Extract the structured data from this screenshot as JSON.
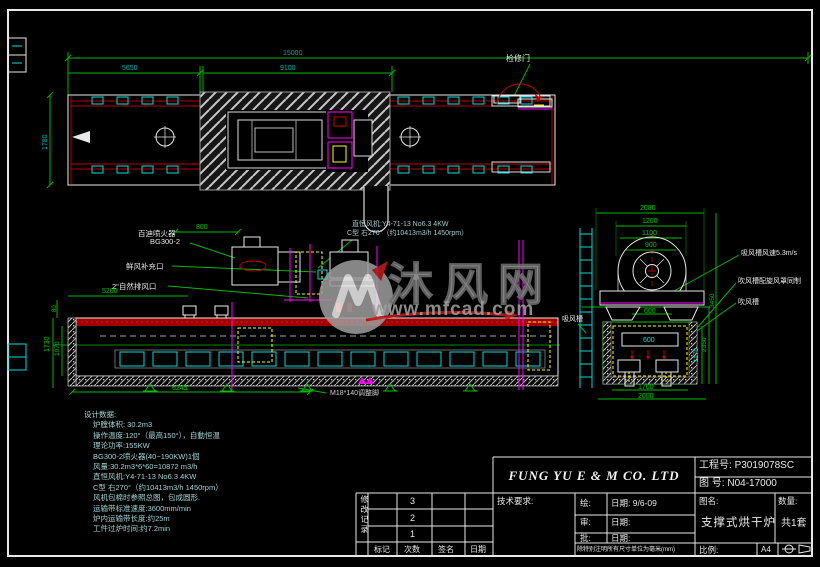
{
  "colors": {
    "background": "#000000",
    "frame": "#e8e8e8",
    "dimension_line": "#00b400",
    "dim_text_teal": "#00a8a8",
    "dim_text_green": "#00c400",
    "conveyor_red": "#b40000",
    "magenta": "#ff00ff",
    "yellow": "#ffff00",
    "cyan": "#00d8d8",
    "note_text": "#9fd4d4",
    "watermark_grey": "#9e9e9e",
    "watermark_red": "#c41c1c"
  },
  "watermark": {
    "site_name": "沐风网",
    "site_url": "www.mfcad.com"
  },
  "design_data": {
    "lines": [
      "设计数据:",
      "炉膛体积: 30.2m3",
      "操作温度:120°（最高150°），自動恒温",
      "理论功率:155KW",
      "BG300-2喷火器(40~190KW)1個",
      "风量:30.2m3*6*60=10872 m3/h",
      "直恒风机:Y4-71-13 No6.3 4KW",
      "C型 右270°（约10413m3/h 1450rpm）",
      "风机包棉时参照总图，包成圆形.",
      "运输带标准速度:3600mm/min",
      "炉内运输带长度:约25m",
      "工件过炉时间:约7.2min"
    ]
  },
  "title_block": {
    "company": "FUNG YU E & M CO. LTD",
    "project_no_label": "工程号:",
    "project_no": "P3019078SC",
    "drawing_no_label": "图  号:",
    "drawing_no": "N04-17000",
    "tech_req_label": "技术要求:",
    "draw_label": "绘:",
    "draw_date_label": "日期:",
    "draw_date": "9/6-09",
    "check_label": "审:",
    "check_date_label": "日期:",
    "approve_label": "批:",
    "approve_date_label": "日期:",
    "note": "除特别注明所有尺寸单位为毫米(mm)",
    "name_label": "图名:",
    "drawing_name": "支撑式烘干炉",
    "qty_label": "数量:",
    "qty_value": "共1套",
    "scale_label": "比例:",
    "paper_size": "A4"
  },
  "revision_table": {
    "vertical_label": "修改记录",
    "rows": [
      "3",
      "2",
      "1"
    ],
    "headers": [
      "标记",
      "次数",
      "签名",
      "日期"
    ]
  },
  "labels": [
    {
      "id": "dim-overall-15000",
      "text": "15000",
      "x": 283,
      "y": 50,
      "color": "teal",
      "size": 7
    },
    {
      "id": "dim-5650",
      "text": "5650",
      "x": 122,
      "y": 65,
      "color": "teal",
      "size": 7
    },
    {
      "id": "dim-9100",
      "text": "9100",
      "x": 280,
      "y": 65,
      "color": "teal",
      "size": 7
    },
    {
      "id": "dim-1780",
      "text": "1780",
      "x": 42,
      "y": 150,
      "color": "teal",
      "size": 7,
      "rot": -90
    },
    {
      "id": "dim-800",
      "text": "800",
      "x": 196,
      "y": 224,
      "color": "green",
      "size": 7
    },
    {
      "id": "dim-5200",
      "text": "5200",
      "x": 102,
      "y": 288,
      "color": "green",
      "size": 7
    },
    {
      "id": "dim-6245",
      "text": "6245",
      "x": 172,
      "y": 385,
      "color": "green",
      "size": 7
    },
    {
      "id": "dim-1730",
      "text": "1730",
      "x": 44,
      "y": 352,
      "color": "green",
      "size": 7,
      "rot": -90
    },
    {
      "id": "dim-1070",
      "text": "1070",
      "x": 55,
      "y": 356,
      "color": "green",
      "size": 6.5,
      "rot": -90
    },
    {
      "id": "dim-80",
      "text": "80",
      "x": 52,
      "y": 312,
      "color": "green",
      "size": 6,
      "rot": -90
    },
    {
      "id": "dim-2080",
      "text": "2080",
      "x": 640,
      "y": 205,
      "color": "green",
      "size": 7
    },
    {
      "id": "dim-1200",
      "text": "1200",
      "x": 642,
      "y": 218,
      "color": "green",
      "size": 7
    },
    {
      "id": "dim-1100",
      "text": "1100",
      "x": 642,
      "y": 230,
      "color": "green",
      "size": 7
    },
    {
      "id": "dim-900",
      "text": "900",
      "x": 645,
      "y": 242,
      "color": "green",
      "size": 7
    },
    {
      "id": "dim-600-base",
      "text": "600",
      "x": 644,
      "y": 308,
      "color": "green",
      "size": 7
    },
    {
      "id": "dim-600-duct",
      "text": "600",
      "x": 643,
      "y": 337,
      "color": "cyan",
      "size": 7
    },
    {
      "id": "dim-1700",
      "text": "1700",
      "x": 638,
      "y": 384,
      "color": "green",
      "size": 7
    },
    {
      "id": "dim-2000",
      "text": "2000",
      "x": 638,
      "y": 393,
      "color": "green",
      "size": 7
    },
    {
      "id": "dim-1170",
      "text": "1170",
      "x": 694,
      "y": 362,
      "color": "cyan",
      "size": 6.5,
      "rot": -90
    },
    {
      "id": "dim-2350",
      "text": "2350",
      "x": 702,
      "y": 352,
      "color": "green",
      "size": 6.5,
      "rot": -90
    },
    {
      "id": "dim-3450",
      "text": "3450",
      "x": 710,
      "y": 308,
      "color": "green",
      "size": 6.5,
      "rot": -90
    },
    {
      "id": "label-inspection-door",
      "text": "检修门",
      "x": 506,
      "y": 55,
      "color": "white",
      "size": 8
    },
    {
      "id": "label-fan-spec-1",
      "text": "直恒风机:Y4-71-13 No6.3 4KW",
      "x": 352,
      "y": 221,
      "color": "grey",
      "size": 7
    },
    {
      "id": "label-fan-spec-2",
      "text": "C型 右270°（约10413m3/h 1450rpm）",
      "x": 347,
      "y": 230,
      "color": "grey",
      "size": 7
    },
    {
      "id": "label-burner-name",
      "text": "百迪喷火器",
      "x": 138,
      "y": 230,
      "color": "white",
      "size": 7.5
    },
    {
      "id": "label-burner-model",
      "text": "BG300-2",
      "x": 150,
      "y": 238,
      "color": "white",
      "size": 7.5
    },
    {
      "id": "label-fresh-air-inlet",
      "text": "鲜风补充口",
      "x": 126,
      "y": 263,
      "color": "white",
      "size": 7.5
    },
    {
      "id": "label-natural-vent",
      "text": "2\"自然排风口",
      "x": 112,
      "y": 283,
      "color": "white",
      "size": 7.5
    },
    {
      "id": "label-adjust-foot",
      "text": "M18*140调整脚",
      "x": 330,
      "y": 390,
      "color": "lightgrey",
      "size": 7
    },
    {
      "id": "label-suction-speed",
      "text": "吸风槽风速5.3m/s",
      "x": 741,
      "y": 250,
      "color": "white",
      "size": 7
    },
    {
      "id": "label-blow-duct-cover",
      "text": "吹风槽配旋风罩同制",
      "x": 738,
      "y": 278,
      "color": "white",
      "size": 7
    },
    {
      "id": "label-blow-duct",
      "text": "吹风槽",
      "x": 738,
      "y": 299,
      "color": "white",
      "size": 7
    },
    {
      "id": "label-suction-duct",
      "text": "吸风槽",
      "x": 562,
      "y": 316,
      "color": "white",
      "size": 7
    }
  ]
}
